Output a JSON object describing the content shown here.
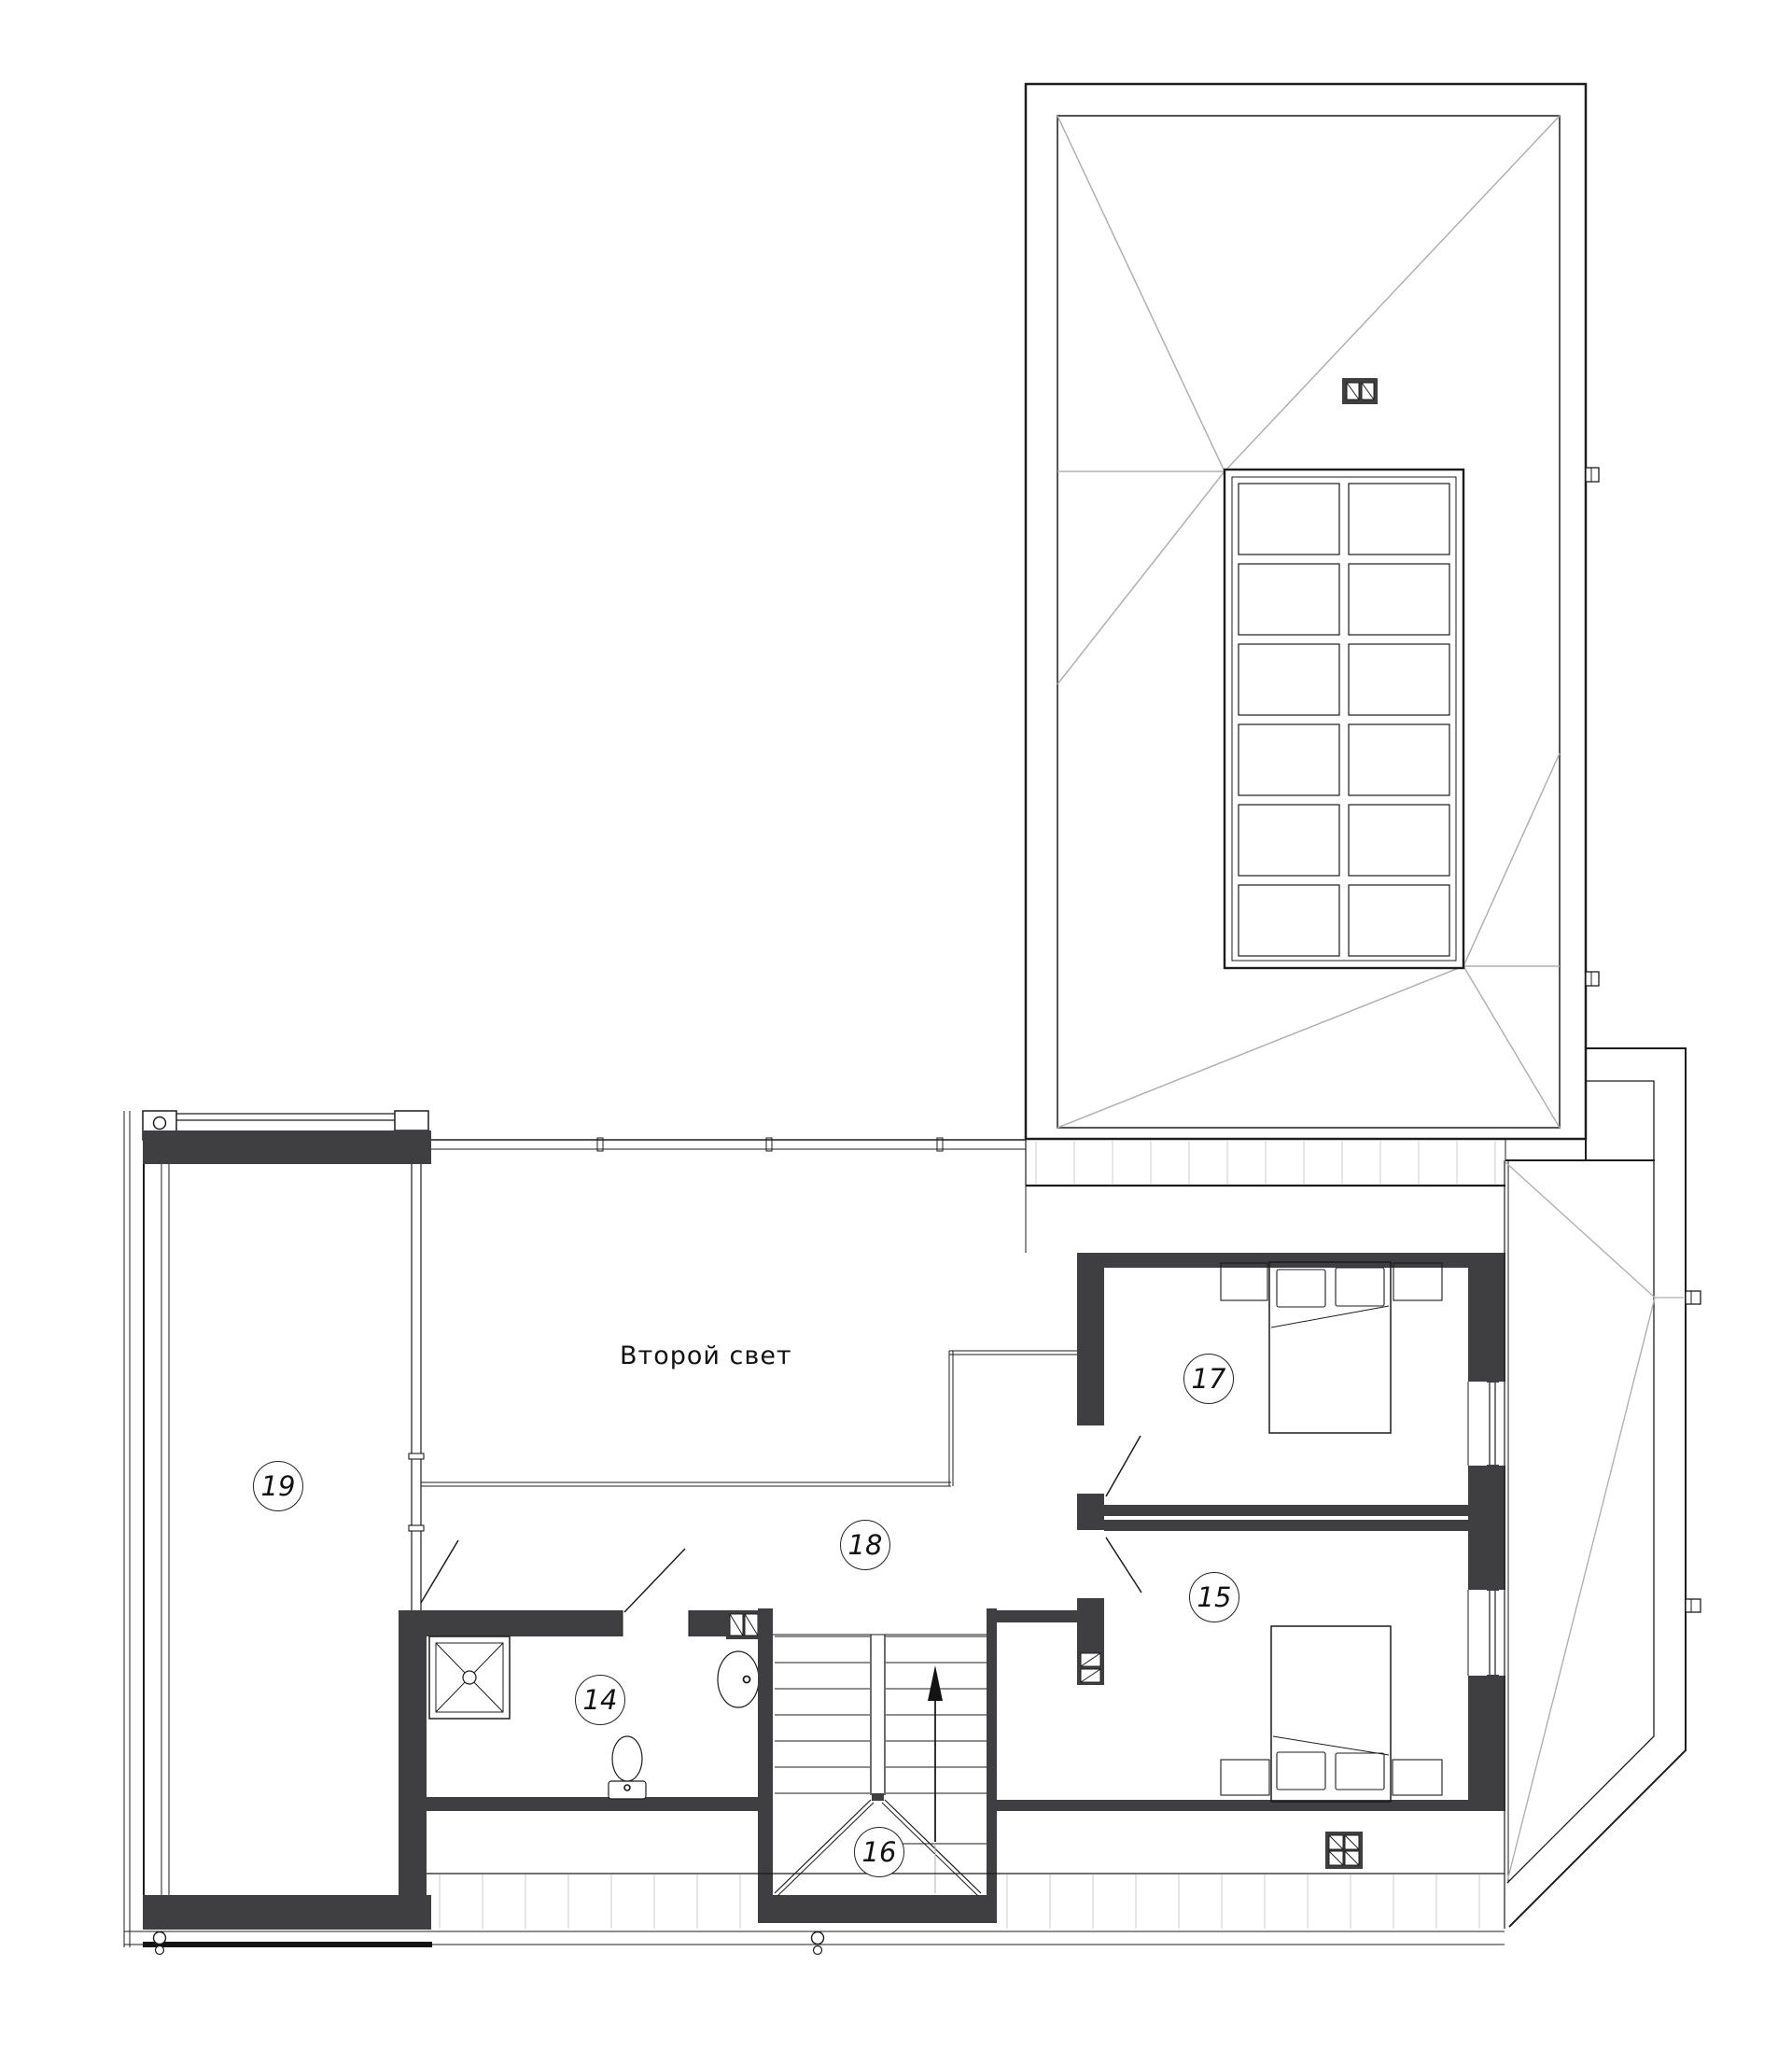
{
  "void": {
    "label": "Второй свет"
  },
  "rooms": {
    "r14": {
      "label": "14"
    },
    "r15": {
      "label": "15"
    },
    "r16": {
      "label": "16"
    },
    "r17": {
      "label": "17"
    },
    "r18": {
      "label": "18"
    },
    "r19": {
      "label": "19"
    }
  },
  "colors": {
    "bg": "#ffffff",
    "wall": "#3f3f41",
    "line": "#1c1c1c",
    "hip": "#b0b0b0",
    "hatch": "#cdcdcd"
  }
}
